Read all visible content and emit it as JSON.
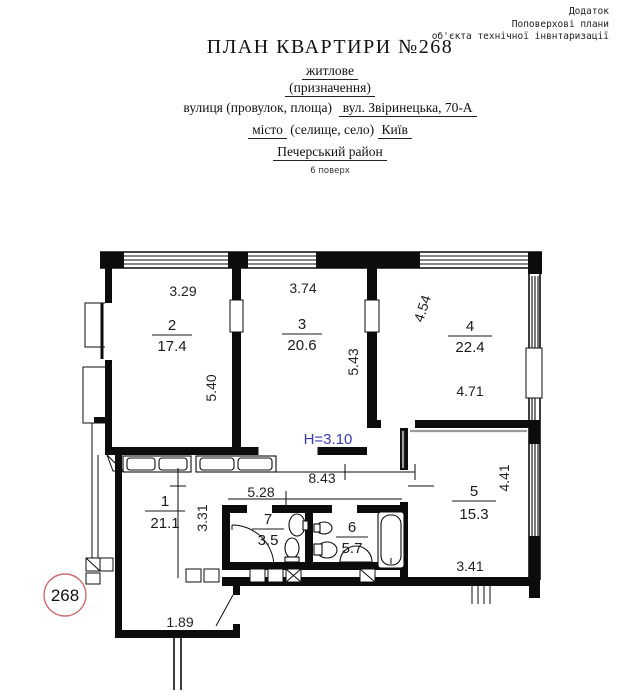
{
  "header": {
    "corner_note_lines": [
      "Додаток",
      "Поповерхові плани",
      "об'єкта технічної інвнтаризації"
    ],
    "title": "ПЛАН КВАРТИРИ №268",
    "purpose_value": "житлове",
    "purpose_label": "(призначення)",
    "street_label": "вулиця (провулок, площа)",
    "street_value": "вул. Звіринецька, 70-А",
    "city_word": "місто",
    "city_label": "(селище, село)",
    "city_value": "Київ",
    "district": "Печерський район",
    "floor": "6 поверх"
  },
  "plan": {
    "apartment_number": "268",
    "ceiling_height": "H=3.10",
    "rooms": [
      {
        "number": "1",
        "area": "21.1"
      },
      {
        "number": "2",
        "area": "17.4"
      },
      {
        "number": "3",
        "area": "20.6"
      },
      {
        "number": "4",
        "area": "22.4"
      },
      {
        "number": "5",
        "area": "15.3"
      },
      {
        "number": "6",
        "area": "5.7"
      },
      {
        "number": "7",
        "area": "3.5"
      }
    ],
    "dimensions": {
      "room2_width": "3.29",
      "room3_width": "3.74",
      "room4_width": "4.54",
      "room2_depth": "5.40",
      "room3_depth": "5.43",
      "room4_depth": "4.71",
      "hall_width": "8.43",
      "hall_depth": "3.31",
      "corridor_width": "5.28",
      "room5_depth": "4.41",
      "room5_width": "3.41",
      "entry_width": "1.89"
    },
    "colors": {
      "height_label": "#3a3aad",
      "circle_outline": "#c87070"
    }
  }
}
